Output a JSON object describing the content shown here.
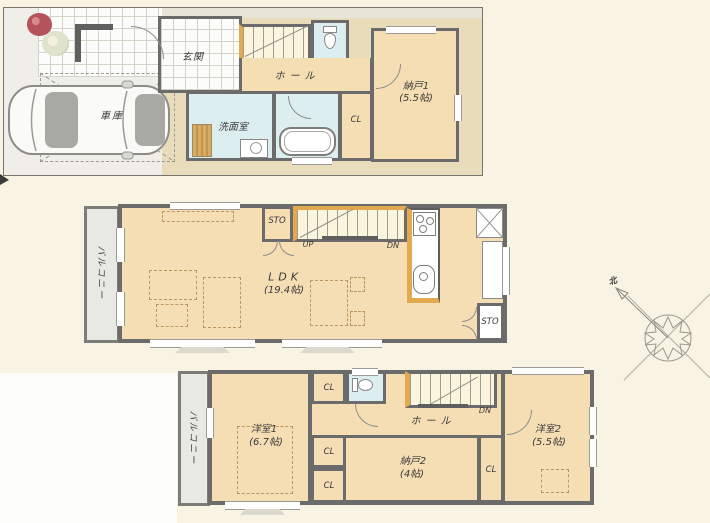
{
  "document": {
    "type": "japanese-house-floorplan",
    "floors": 3
  },
  "colors": {
    "background": "#f8f3e3",
    "room_floor": "#f5ddb4",
    "wet_room": "#ddeef0",
    "wall": "#6b6b6b",
    "wood_accent": "#e3a94f",
    "stair_fill": "#fcf5dd",
    "balcony_fill": "#e9e9e4",
    "lot_fill": "#e9dcba",
    "driveway": "#efeee8"
  },
  "floor1": {
    "labels": {
      "garage": "車庫",
      "genkan": "玄関",
      "up": "UP",
      "hall": "ホール",
      "storage1": "納戸1",
      "storage1_size": "(5.5帖)",
      "closet": "CL",
      "washroom": "洗面室"
    }
  },
  "floor2": {
    "labels": {
      "balcony": "バルコニー",
      "sto_top": "STO",
      "up": "UP",
      "dn": "DN",
      "ldk": "LDK",
      "ldk_size": "(19.4帖)",
      "sto_bottom": "STO"
    }
  },
  "floor3": {
    "labels": {
      "balcony": "バルコニー",
      "cl_top": "CL",
      "dn": "DN",
      "hall": "ホール",
      "room1": "洋室1",
      "room1_size": "(6.7帖)",
      "cl_mid": "CL",
      "cl_bottom": "CL",
      "storage2": "納戸2",
      "storage2_size": "(4帖)",
      "cl_right": "CL",
      "room2": "洋室2",
      "room2_size": "(5.5帖)"
    }
  },
  "compass": {
    "north": "北"
  }
}
